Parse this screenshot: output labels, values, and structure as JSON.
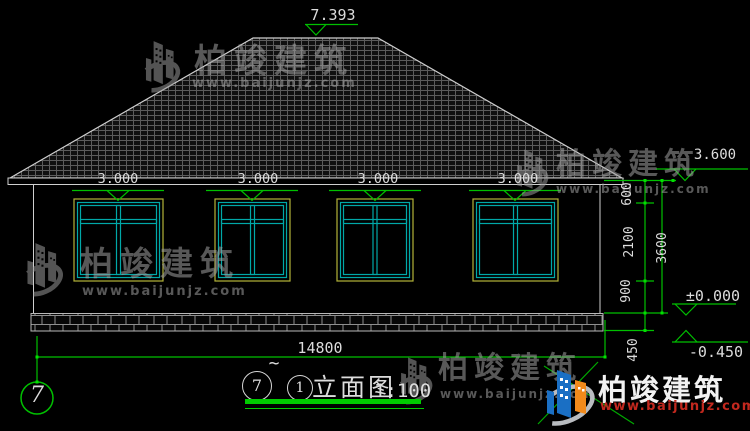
{
  "drawing": {
    "ridge_level": "7.393",
    "eave_level": "3.600",
    "window_levels": [
      "3.000",
      "3.000",
      "3.000",
      "3.000"
    ],
    "floor_level": "±0.000",
    "ground_level": "-0.450",
    "dims": {
      "d600": "600",
      "d2100": "2100",
      "d900": "900",
      "d450": "450",
      "d3600": "3600",
      "d14800": "14800"
    }
  },
  "axis_bubble": "7",
  "title_bar": {
    "axis_from": "7",
    "separator": "~",
    "axis_to": "1",
    "name": "立面图",
    "scale": "1:100"
  },
  "watermark": {
    "brand": "柏竣建筑",
    "url": "www.baijunjz.com"
  },
  "brand": {
    "name": "柏竣建筑",
    "url": "www.baijunjz.com"
  },
  "colors": {
    "background": "#000000",
    "line": "#cfcfcf",
    "dimension_green": "#00c000",
    "window_frame_yellow": "#b3b338",
    "window_sash_cyan": "#00a8a8",
    "brand_red": "#c2281e"
  }
}
